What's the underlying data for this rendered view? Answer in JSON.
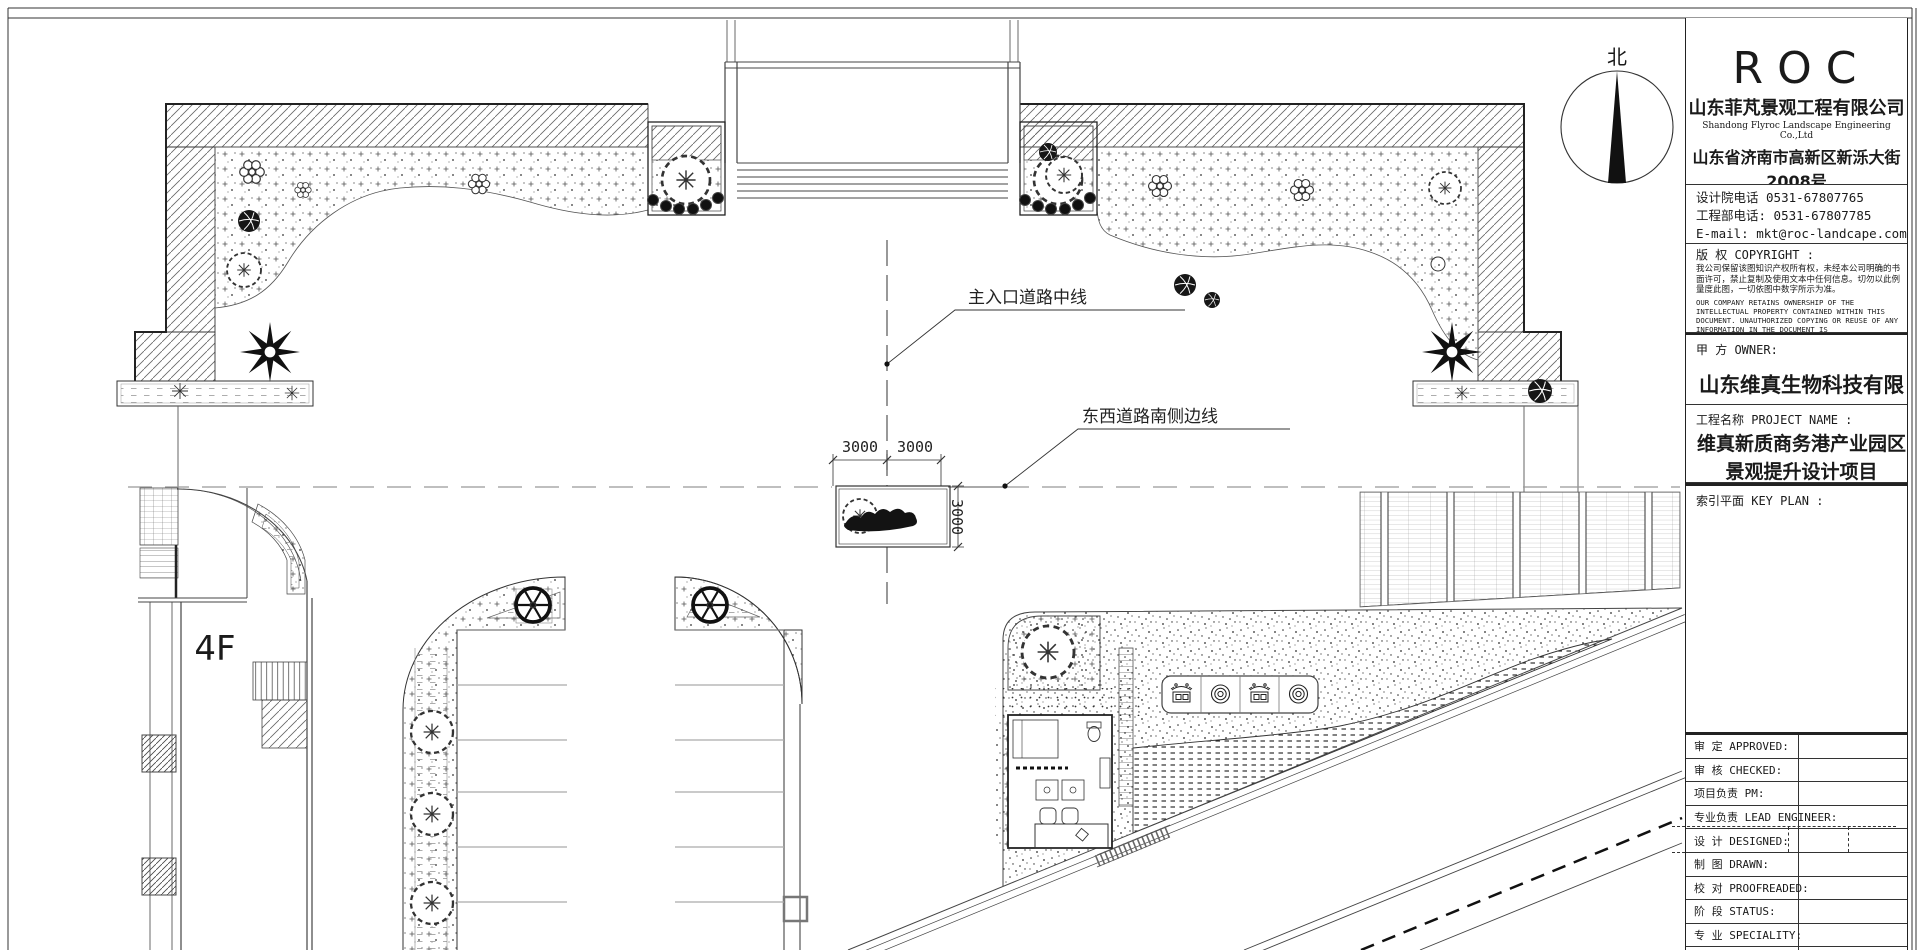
{
  "compass": {
    "north_label": "北"
  },
  "plan": {
    "labels": {
      "main_entrance_centerline": "主入口道路中线",
      "east_west_road_edge": "东西道路南侧边线",
      "building_floors": "4F"
    },
    "dims": [
      "3000",
      "3000",
      "3000"
    ]
  },
  "title_block": {
    "logo": "ROC",
    "company_cn": "山东菲芃景观工程有限公司",
    "company_en": "Shandong Flyroc Landscape Engineering Co.,Ltd",
    "address_line1": "山东省济南市高新区新泺大街2008号",
    "address_line2": "银荷大厦C座6F",
    "phone_design": "设计院电话 0531-67807765",
    "phone_eng": "工程部电话: 0531-67807785",
    "email": "E-mail: mkt@roc-landcape.com",
    "copyright_title": "版 权 COPYRIGHT :",
    "copyright_cn": "我公司保留该图知识产权所有权，未经本公司明确的书面许可，禁止复制及使用文本中任何信息。切勿以此例量度此图，一切依图中数字所示为准。",
    "copyright_en": "OUR COMPANY RETAINS OWNERSHIP OF THE INTELLECTUAL PROPERTY CONTAINED WITHIN THIS DOCUMENT. UNAUTHORIZED COPYING OR REUSE OF ANY INFORMATION IN THE DOCUMENT IS STRICTLYPROHIBITED. DON'T MEASURE THE FIGURE IN PROPORTION. EVERYTING IS IN ACCORDANCE WITH THE NUMBER SHOWN IN FIGURE.",
    "owner_label": "甲  方 OWNER:",
    "owner_value": "山东维真生物科技有限公司",
    "project_label": "工程名称 PROJECT NAME :",
    "project_line1": "维真新质商务港产业园区",
    "project_line2": "景观提升设计项目",
    "keyplan_label": "索引平面 KEY PLAN :",
    "rows": [
      {
        "label": "审 定 APPROVED:"
      },
      {
        "label": "审 核 CHECKED:"
      },
      {
        "label": "项目负责 PM:"
      },
      {
        "label": "专业负责 LEAD ENGINEER:"
      },
      {
        "label": "设 计 DESIGNED:"
      },
      {
        "label": "制 图 DRAWN:"
      },
      {
        "label": "校 对 PROOFREADED:"
      },
      {
        "label": "阶 段 STATUS:"
      },
      {
        "label": "专 业 SPECIALITY:"
      },
      {
        "label": "工程编号 PROJECT NUMBER"
      }
    ]
  }
}
